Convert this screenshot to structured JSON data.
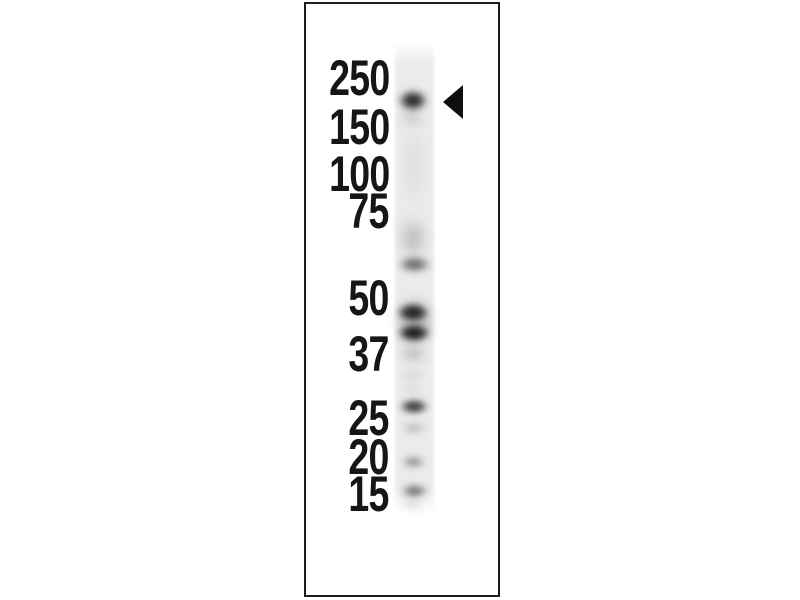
{
  "figure": {
    "type": "western-blot",
    "description": "Single-lane western blot with molecular weight marker labels and an arrowhead indicating the top band",
    "colors": {
      "background": "#ffffff",
      "panel_border": "#1c1c1c",
      "label_text": "#161616",
      "lane": "#ebebeb",
      "band": "#0a0a0a",
      "arrow": "#0f0f0f"
    },
    "panel": {
      "left": 304,
      "top": 2,
      "width": 196,
      "height": 595
    },
    "markers": {
      "right_edge_x": 389,
      "items": [
        {
          "label": "250",
          "y": 78
        },
        {
          "label": "150",
          "y": 127
        },
        {
          "label": "100",
          "y": 174
        },
        {
          "label": "75",
          "y": 211
        },
        {
          "label": "50",
          "y": 298
        },
        {
          "label": "37",
          "y": 354
        },
        {
          "label": "25",
          "y": 418
        },
        {
          "label": "20",
          "y": 457
        },
        {
          "label": "15",
          "y": 494
        }
      ]
    },
    "lane": {
      "left": 395,
      "top": 42,
      "width": 39,
      "height": 473
    },
    "bands": [
      {
        "name": "band-top-arrowed",
        "cx": 413,
        "cy": 100,
        "w": 32,
        "h": 23,
        "opacity": 0.93,
        "blur": 3.5
      },
      {
        "name": "band-top-tail",
        "cx": 412,
        "cy": 118,
        "w": 26,
        "h": 14,
        "opacity": 0.2,
        "blur": 5
      },
      {
        "name": "smear-upper-lane",
        "cx": 414,
        "cy": 165,
        "w": 26,
        "h": 95,
        "opacity": 0.05,
        "blur": 6
      },
      {
        "name": "smear-mid",
        "cx": 413,
        "cy": 238,
        "w": 28,
        "h": 44,
        "opacity": 0.22,
        "blur": 6
      },
      {
        "name": "band-2",
        "cx": 414,
        "cy": 264,
        "w": 35,
        "h": 17,
        "opacity": 0.62,
        "blur": 3.5
      },
      {
        "name": "band-cluster-halo",
        "cx": 414,
        "cy": 322,
        "w": 39,
        "h": 54,
        "opacity": 0.28,
        "blur": 6
      },
      {
        "name": "band-3a",
        "cx": 413,
        "cy": 312,
        "w": 36,
        "h": 21,
        "opacity": 0.9,
        "blur": 3
      },
      {
        "name": "band-3b",
        "cx": 414,
        "cy": 333,
        "w": 36,
        "h": 20,
        "opacity": 0.95,
        "blur": 3
      },
      {
        "name": "band-3-tail",
        "cx": 413,
        "cy": 354,
        "w": 30,
        "h": 12,
        "opacity": 0.3,
        "blur": 5
      },
      {
        "name": "spot-faint-1",
        "cx": 413,
        "cy": 374,
        "w": 24,
        "h": 9,
        "opacity": 0.14,
        "blur": 4
      },
      {
        "name": "spot-faint-2",
        "cx": 413,
        "cy": 389,
        "w": 22,
        "h": 8,
        "opacity": 0.12,
        "blur": 4
      },
      {
        "name": "band-4",
        "cx": 414,
        "cy": 406,
        "w": 32,
        "h": 17,
        "opacity": 0.8,
        "blur": 3
      },
      {
        "name": "band-5-faint",
        "cx": 414,
        "cy": 428,
        "w": 26,
        "h": 10,
        "opacity": 0.28,
        "blur": 4
      },
      {
        "name": "band-6",
        "cx": 413,
        "cy": 462,
        "w": 25,
        "h": 12,
        "opacity": 0.45,
        "blur": 3.5
      },
      {
        "name": "band-7",
        "cx": 414,
        "cy": 491,
        "w": 29,
        "h": 14,
        "opacity": 0.6,
        "blur": 3.5
      },
      {
        "name": "band-7-tail",
        "cx": 413,
        "cy": 504,
        "w": 24,
        "h": 8,
        "opacity": 0.18,
        "blur": 4
      }
    ],
    "arrow": {
      "tip_x": 443,
      "center_y": 102,
      "width": 20,
      "height": 34
    }
  }
}
